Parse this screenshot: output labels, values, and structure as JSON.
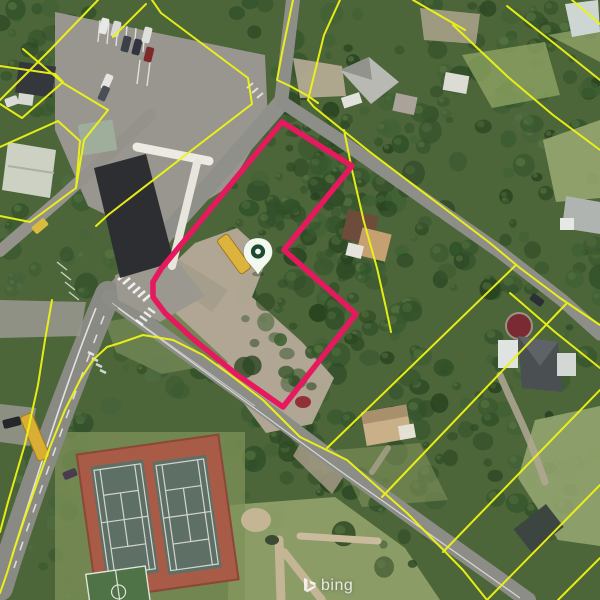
{
  "map": {
    "view": "aerial-satellite",
    "colors": {
      "parcel_lines": "#eef414",
      "selected_parcel": "#e6195f",
      "pin_fill": "#f2f9ee",
      "pin_ring": "#1d4a34"
    },
    "selected_parcel": {
      "vertices": [
        [
          282,
          122
        ],
        [
          352,
          166
        ],
        [
          284,
          250
        ],
        [
          356,
          314
        ],
        [
          283,
          407
        ],
        [
          236,
          374
        ],
        [
          192,
          338
        ],
        [
          165,
          313
        ],
        [
          153,
          297
        ],
        [
          153,
          282
        ],
        [
          161,
          269
        ]
      ]
    },
    "pin": {
      "x": 258,
      "y": 260
    }
  },
  "watermark": {
    "text": "bing"
  }
}
